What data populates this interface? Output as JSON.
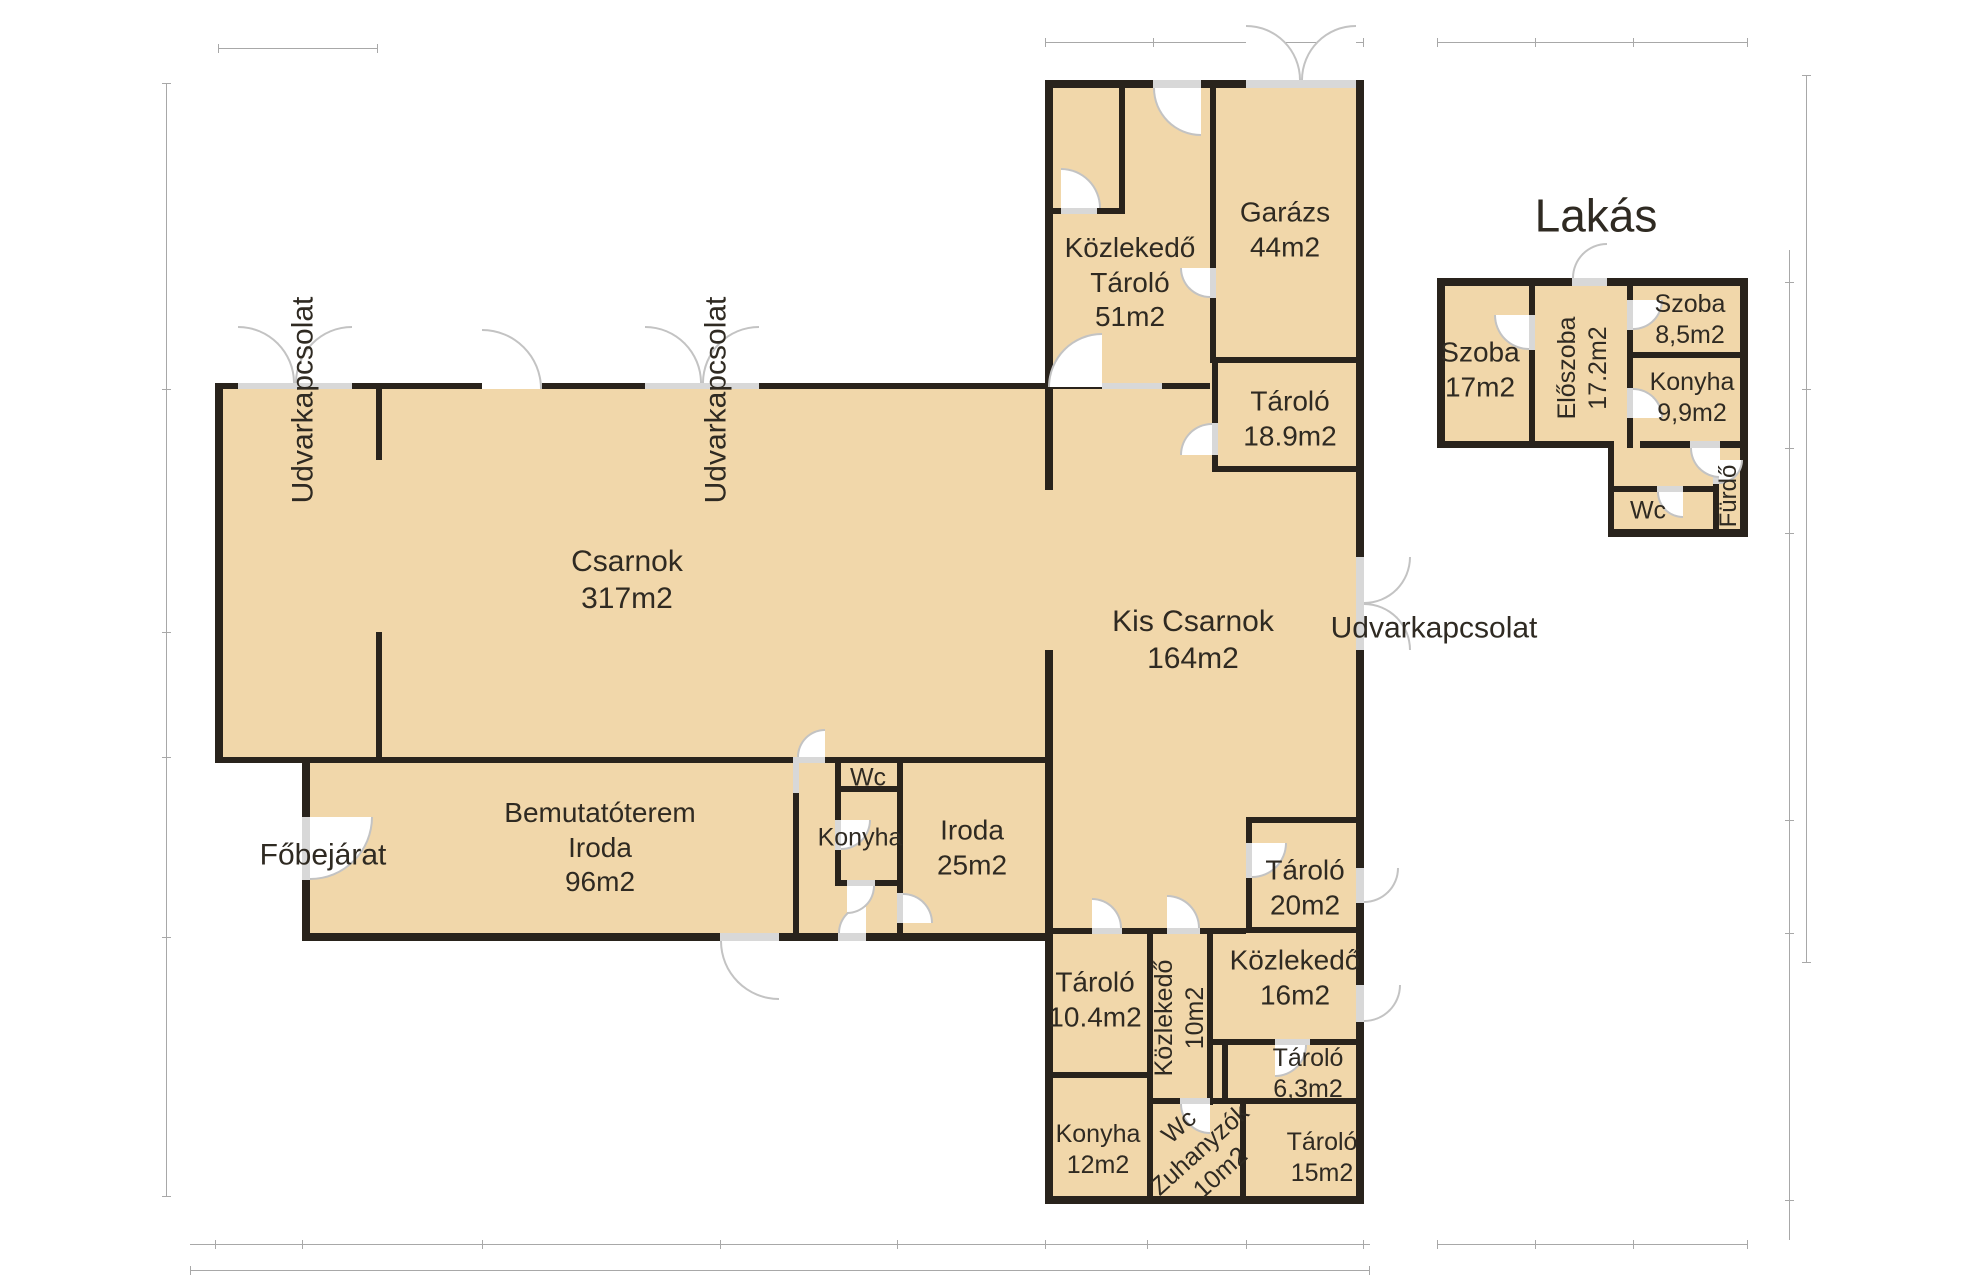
{
  "colors": {
    "floor": "#f1d7aa",
    "wall": "#29231c",
    "door_opening": "#d8d8d8",
    "door_arc": "#c3c3c3",
    "text": "#2f2a22",
    "dimension_line": "#a8a8a8"
  },
  "halls": {
    "csarnok": {
      "name": "Csarnok",
      "area": "317m2"
    },
    "kis_csarnok": {
      "name": "Kis Csarnok",
      "area": "164m2"
    }
  },
  "rooms": {
    "garazs": {
      "name": "Garázs",
      "area": "44m2"
    },
    "kozlekedo_tarolo": {
      "name": "Közlekedő",
      "name2": "Tároló",
      "area": "51m2"
    },
    "tarolo189": {
      "name": "Tároló",
      "area": "18.9m2"
    },
    "bemutatoterem": {
      "name": "Bemutatóterem",
      "name2": "Iroda",
      "area": "96m2"
    },
    "wc_kicsi": {
      "name": "Wc"
    },
    "konyha_kicsi": {
      "name": "Konyha"
    },
    "iroda": {
      "name": "Iroda",
      "area": "25m2"
    },
    "tarolo20": {
      "name": "Tároló",
      "area": "20m2"
    },
    "tarolo104": {
      "name": "Tároló",
      "area": "10.4m2"
    },
    "kozlekedo10": {
      "name": "Közlekedő",
      "area": "10m2"
    },
    "kozlekedo16": {
      "name": "Közlekedő",
      "area": "16m2"
    },
    "tarolo63": {
      "name": "Tároló",
      "area": "6,3m2"
    },
    "konyha12": {
      "name": "Konyha",
      "area": "12m2"
    },
    "wc_zuhanyzok": {
      "name": "Wc",
      "name2": "Zuhanyzók",
      "area": "10m2"
    },
    "tarolo15": {
      "name": "Tároló",
      "area": "15m2"
    }
  },
  "apartment": {
    "title": "Lakás",
    "rooms": {
      "szoba17": {
        "name": "Szoba",
        "area": "17m2"
      },
      "eloszoba": {
        "name": "Előszoba",
        "area": "17.2m2"
      },
      "szoba85": {
        "name": "Szoba",
        "area": "8,5m2"
      },
      "konyha99": {
        "name": "Konyha",
        "area": "9,9m2"
      },
      "wc": {
        "name": "Wc"
      },
      "furdo": {
        "name": "Fürdő"
      }
    }
  },
  "site_labels": {
    "fobejarat": "Főbejárat",
    "udvarkapcsolat_left": "Udvarkapcsolat",
    "udvarkapcsolat_mid": "Udvarkapcsolat",
    "udvarkapcsolat_right": "Udvarkapcsolat"
  }
}
